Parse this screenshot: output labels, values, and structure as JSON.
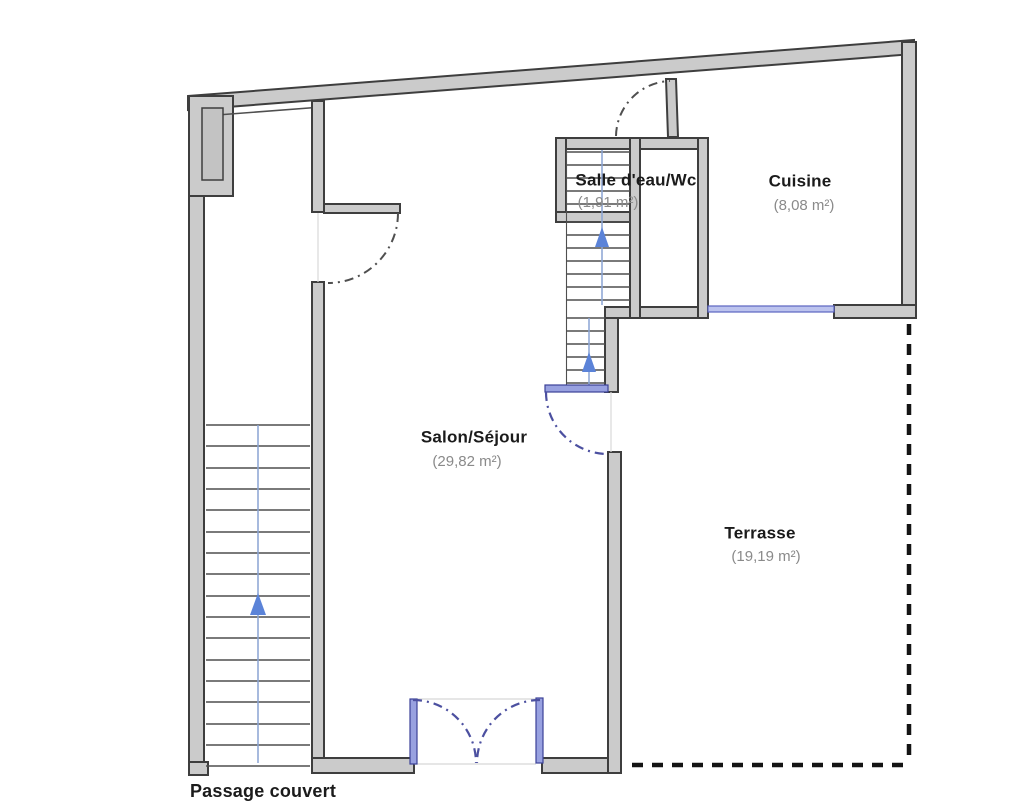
{
  "rooms": {
    "salle_eau": {
      "name": "Salle d'eau/Wc",
      "area": "(1,91 m²)"
    },
    "cuisine": {
      "name": "Cuisine",
      "area": "(8,08 m²)"
    },
    "salon": {
      "name": "Salon/Séjour",
      "area": "(29,82 m²)"
    },
    "terrasse": {
      "name": "Terrasse",
      "area": "(19,19 m²)"
    },
    "passage": {
      "name": "Passage couvert"
    }
  },
  "colors": {
    "wall_fill": "#cbcbcb",
    "wall_stroke": "#3e3e3e",
    "pillar_fill": "#c3c3c3",
    "stair_line": "#4f4f4f",
    "stair_guide": "#8aa4d4",
    "arrow_blue": "#5b83d8",
    "arc_gray": "#4f4f4f",
    "arc_blue": "#4c50a0",
    "window_fill": "#bcc3ee",
    "window_stroke": "#5a63c0",
    "door_blue_fill": "#98a1e0",
    "door_blue_stroke": "#3b4198",
    "terrace_dash": "#141414",
    "label_dark": "#1b1b1b",
    "label_gray": "#8a8a8a"
  }
}
